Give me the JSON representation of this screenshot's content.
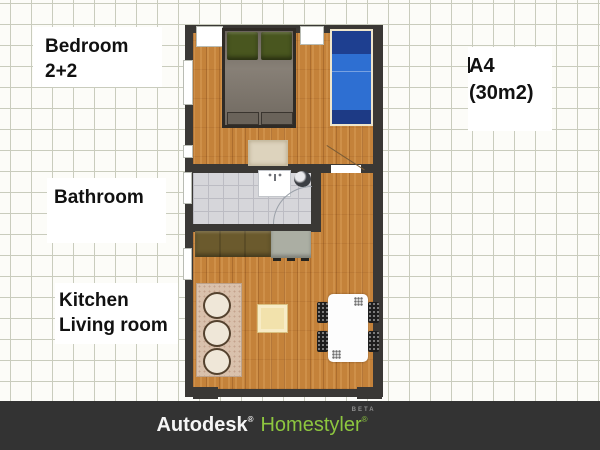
{
  "annotations": {
    "bedroom": {
      "line1": "Bedroom",
      "line2": "2+2"
    },
    "bathroom": {
      "line1": "Bathroom"
    },
    "kitchen": {
      "line1": "Kitchen",
      "line2": "Living room"
    },
    "plan": {
      "line1": "A4",
      "line2": "(30m2)"
    }
  },
  "footer": {
    "brand_primary": "Autodesk",
    "brand_primary_reg": "®",
    "brand_secondary": "Homestyler",
    "brand_secondary_reg": "®",
    "beta_tag": "BETA"
  },
  "colors": {
    "wall": "#3a3835",
    "wood_floor": "#c4823a",
    "tile_floor": "#d6d6da",
    "grid_line": "#c9ccbd",
    "footer_bg": "#333333",
    "homestyler_green": "#8dc63f",
    "single_bed_blue": "#2e6fd2",
    "single_bed_pillow": "#1e3f90",
    "double_bed_blanket": "#7d756b",
    "pillow_green": "#49561f",
    "sofa_beige": "#d9c1ac",
    "coffee_table_yellow": "#f2e2ac",
    "counter_brown": "#6b5a2d",
    "appliance_gray": "#abaea3"
  }
}
